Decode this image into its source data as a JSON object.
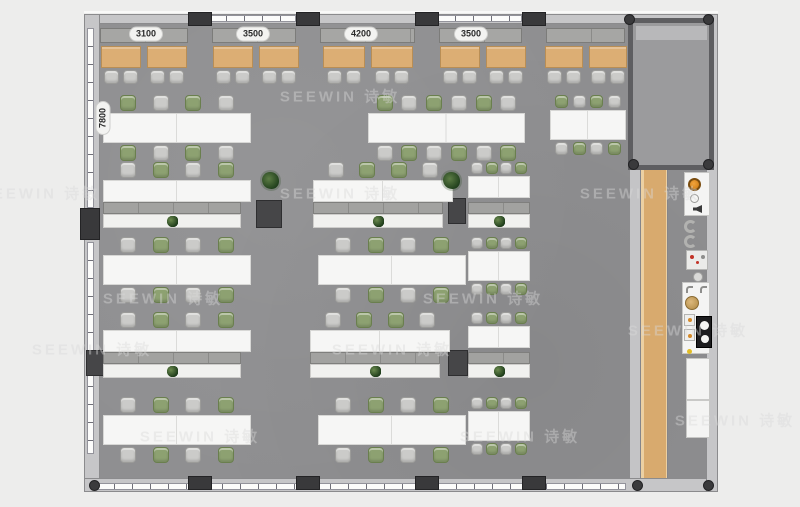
{
  "canvas": {
    "width": 800,
    "height": 507,
    "background": "#ededec"
  },
  "watermark": {
    "text": "SEEWIN 诗敏",
    "positions": [
      [
        340,
        96
      ],
      [
        40,
        193
      ],
      [
        340,
        193
      ],
      [
        640,
        193
      ],
      [
        163,
        298
      ],
      [
        483,
        298
      ],
      [
        92,
        349
      ],
      [
        392,
        349
      ],
      [
        688,
        330
      ],
      [
        200,
        436
      ],
      [
        520,
        436
      ],
      [
        735,
        420
      ]
    ]
  },
  "dimensions": {
    "top": [
      {
        "label": "3100"
      },
      {
        "label": "3500"
      },
      {
        "label": "4200"
      },
      {
        "label": "3500"
      }
    ],
    "side": {
      "label": "7800"
    }
  },
  "palette": {
    "floor": "#8f8f91",
    "wall": "#c6c6c8",
    "pillar": "#39393b",
    "wood_table": "#dcae74",
    "wood_floor": "#d8aa6e",
    "chair_gray": "#cbcbc9",
    "chair_green": "#8da171",
    "desk_white": "#f6f6f5",
    "plant_green": "#2c4a24",
    "burner_orange": "#d9881c"
  },
  "icons": [
    "plant-icon",
    "round-plant-icon",
    "burner-icon",
    "dial-icon",
    "speaker-icon",
    "lounge-chair-icon",
    "coffee-machine-icon",
    "stool-icon",
    "faucet-icon",
    "sink-icon",
    "appliance-icon",
    "cooktop-icon"
  ],
  "structure_layers": [
    {
      "name": "outer-wall",
      "class": "wall",
      "rects": [
        [
          84,
          14,
          634,
          10
        ],
        [
          84,
          14,
          16,
          478
        ],
        [
          84,
          478,
          634,
          14
        ],
        [
          706,
          14,
          12,
          478
        ]
      ]
    },
    {
      "name": "exterior-line",
      "class": "line",
      "rects": [
        [
          84,
          11,
          634,
          2
        ]
      ]
    },
    {
      "name": "main-floor",
      "class": "floor",
      "rects": [
        [
          100,
          24,
          606,
          454
        ]
      ]
    },
    {
      "name": "window-strip",
      "class": "win-h",
      "rects": [
        [
          208,
          15,
          88,
          7
        ],
        [
          437,
          15,
          85,
          7
        ],
        [
          96,
          483,
          530,
          7
        ]
      ]
    },
    {
      "name": "window-strip-left",
      "class": "win-v",
      "rects": [
        [
          87,
          28,
          7,
          180
        ],
        [
          87,
          242,
          7,
          212
        ]
      ]
    },
    {
      "name": "corridor-edge-band",
      "class": "band",
      "rects": [
        [
          630,
          170,
          10,
          308
        ]
      ]
    },
    {
      "name": "wood-walkway",
      "class": "woodfloor",
      "rects": [
        [
          640,
          170,
          28,
          308
        ]
      ]
    },
    {
      "name": "wall-cabinet",
      "class": "cab",
      "rects": [
        [
          100,
          28,
          88,
          15
        ],
        [
          212,
          28,
          84,
          15
        ],
        [
          320,
          28,
          95,
          15
        ],
        [
          439,
          28,
          83,
          15
        ],
        [
          546,
          28,
          79,
          15
        ]
      ]
    },
    {
      "name": "meeting-room",
      "class": "room",
      "rects": [
        [
          628,
          18,
          86,
          152
        ]
      ]
    },
    {
      "name": "meeting-room-strip",
      "class": "roomstrip",
      "rects": [
        [
          636,
          26,
          71,
          14
        ]
      ]
    },
    {
      "name": "column-pillar",
      "class": "pillar",
      "rects": [
        [
          188,
          12,
          24,
          14
        ],
        [
          296,
          12,
          24,
          14
        ],
        [
          415,
          12,
          24,
          14
        ],
        [
          522,
          12,
          24,
          14
        ],
        [
          188,
          476,
          24,
          14
        ],
        [
          296,
          476,
          24,
          14
        ],
        [
          415,
          476,
          24,
          14
        ],
        [
          522,
          476,
          24,
          14
        ],
        [
          80,
          208,
          20,
          32
        ]
      ]
    },
    {
      "name": "storage-block",
      "class": "dark",
      "rects": [
        [
          256,
          200,
          26,
          28
        ],
        [
          448,
          198,
          18,
          26
        ],
        [
          86,
          350,
          22,
          26
        ],
        [
          448,
          350,
          20,
          26
        ]
      ]
    },
    {
      "name": "column-dot",
      "class": "dot",
      "rects": [
        [
          624,
          14,
          11,
          11
        ],
        [
          703,
          14,
          11,
          11
        ],
        [
          628,
          159,
          11,
          11
        ],
        [
          703,
          159,
          11,
          11
        ],
        [
          89,
          480,
          11,
          11
        ],
        [
          632,
          480,
          11,
          11
        ],
        [
          703,
          480,
          11,
          11
        ]
      ]
    }
  ],
  "furniture": {
    "wood_tables": [
      {
        "x": 101,
        "w": 40
      },
      {
        "x": 147,
        "w": 40
      },
      {
        "x": 213,
        "w": 40
      },
      {
        "x": 259,
        "w": 40
      },
      {
        "x": 323,
        "w": 42
      },
      {
        "x": 371,
        "w": 42
      },
      {
        "x": 440,
        "w": 40
      },
      {
        "x": 486,
        "w": 40
      },
      {
        "x": 545,
        "w": 38
      },
      {
        "x": 589,
        "w": 38
      }
    ],
    "clusters": [
      {
        "x": 103,
        "y": 95,
        "w": 148,
        "ch": 16,
        "th": 30,
        "top": [
          "g",
          "y",
          "g",
          "y"
        ],
        "bot": [
          "g",
          "y",
          "g",
          "y"
        ]
      },
      {
        "x": 368,
        "y": 95,
        "w": 157,
        "ch": 16,
        "th": 30,
        "top": [
          "g",
          "y",
          "g",
          "y",
          "g",
          "y"
        ],
        "bot": [
          "y",
          "g",
          "y",
          "g",
          "y",
          "g"
        ]
      },
      {
        "x": 550,
        "y": 95,
        "w": 76,
        "ch": 13,
        "th": 30,
        "top": [
          "g",
          "y",
          "g",
          "y"
        ],
        "bot": [
          "y",
          "g",
          "y",
          "g"
        ]
      },
      {
        "x": 103,
        "y": 162,
        "w": 148,
        "ch": 16,
        "th": 22,
        "top": [
          "y",
          "g",
          "y",
          "g"
        ],
        "bot": []
      },
      {
        "x": 313,
        "y": 162,
        "w": 140,
        "ch": 16,
        "th": 22,
        "top": [
          "y",
          "g",
          "g",
          "y"
        ],
        "bot": []
      },
      {
        "x": 468,
        "y": 162,
        "w": 62,
        "ch": 12,
        "th": 22,
        "top": [
          "y",
          "g",
          "y",
          "g"
        ],
        "bot": []
      },
      {
        "x": 103,
        "y": 237,
        "w": 148,
        "ch": 16,
        "th": 30,
        "top": [
          "y",
          "g",
          "y",
          "g"
        ],
        "bot": [
          "y",
          "g",
          "y",
          "g"
        ]
      },
      {
        "x": 318,
        "y": 237,
        "w": 148,
        "ch": 16,
        "th": 30,
        "top": [
          "y",
          "g",
          "y",
          "g"
        ],
        "bot": [
          "y",
          "g",
          "y",
          "g"
        ]
      },
      {
        "x": 468,
        "y": 237,
        "w": 62,
        "ch": 12,
        "th": 30,
        "top": [
          "y",
          "g",
          "y",
          "g"
        ],
        "bot": [
          "y",
          "g",
          "y",
          "g"
        ]
      },
      {
        "x": 103,
        "y": 312,
        "w": 148,
        "ch": 16,
        "th": 22,
        "top": [
          "y",
          "g",
          "y",
          "g"
        ],
        "bot": []
      },
      {
        "x": 310,
        "y": 312,
        "w": 140,
        "ch": 16,
        "th": 22,
        "top": [
          "y",
          "g",
          "g",
          "y"
        ],
        "bot": []
      },
      {
        "x": 468,
        "y": 312,
        "w": 62,
        "ch": 12,
        "th": 22,
        "top": [
          "y",
          "g",
          "y",
          "g"
        ],
        "bot": []
      },
      {
        "x": 103,
        "y": 397,
        "w": 148,
        "ch": 16,
        "th": 30,
        "top": [
          "y",
          "g",
          "y",
          "g"
        ],
        "bot": [
          "y",
          "g",
          "y",
          "g"
        ]
      },
      {
        "x": 318,
        "y": 397,
        "w": 148,
        "ch": 16,
        "th": 30,
        "top": [
          "y",
          "g",
          "y",
          "g"
        ],
        "bot": [
          "y",
          "g",
          "y",
          "g"
        ]
      },
      {
        "x": 468,
        "y": 397,
        "w": 62,
        "ch": 12,
        "th": 30,
        "top": [
          "y",
          "g",
          "y",
          "g"
        ],
        "bot": [
          "y",
          "g",
          "y",
          "g"
        ]
      }
    ],
    "planter_rows": [
      {
        "x": 103,
        "y": 202,
        "w": 138,
        "plants": 4
      },
      {
        "x": 313,
        "y": 202,
        "w": 130,
        "plants": 4
      },
      {
        "x": 468,
        "y": 202,
        "w": 62,
        "plants": 3
      },
      {
        "x": 103,
        "y": 352,
        "w": 138,
        "plants": 4
      },
      {
        "x": 310,
        "y": 352,
        "w": 130,
        "plants": 4
      },
      {
        "x": 468,
        "y": 352,
        "w": 62,
        "plants": 3
      }
    ],
    "round_plants": [
      {
        "x": 262,
        "y": 172
      },
      {
        "x": 443,
        "y": 172
      }
    ]
  }
}
